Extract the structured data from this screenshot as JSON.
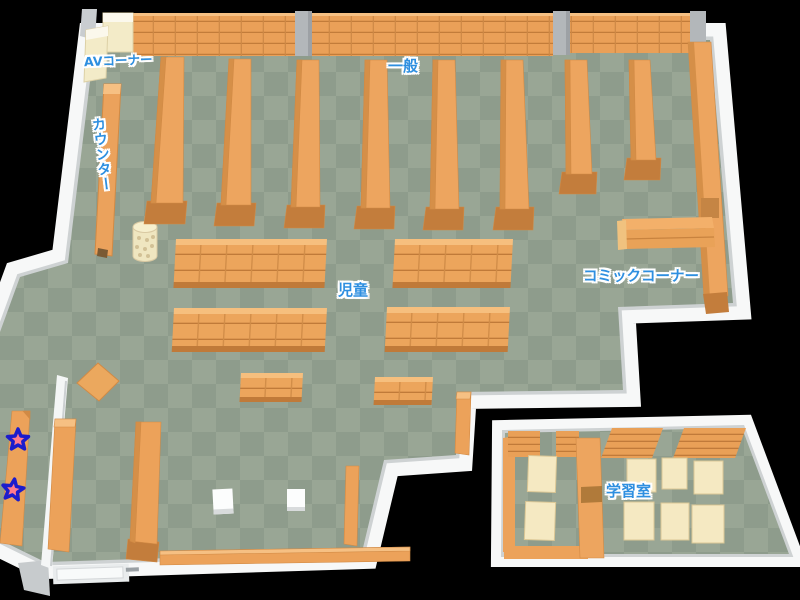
{
  "labels": {
    "av_corner": "AVコーナー",
    "counter": "カウンター",
    "general": "一般",
    "children": "児童",
    "comic_corner": "コミックコーナー",
    "study_room": "学習室"
  },
  "markers": {
    "star_count": 2,
    "star_fill": "#ff7b8c",
    "star_outline": "#1c1ccc"
  },
  "colors": {
    "label_text": "#2e8fe0",
    "label_outline": "#ffffff",
    "floor_dark": "#8e9c8c",
    "floor_light": "#99a695",
    "shelf_orange": "#eda55f",
    "shelf_line": "#c27c3a",
    "table_cream": "#f4e9c3",
    "wall_white": "#f7f8f8",
    "pillar_gray": "#b3b7ba",
    "background": "#000000"
  }
}
